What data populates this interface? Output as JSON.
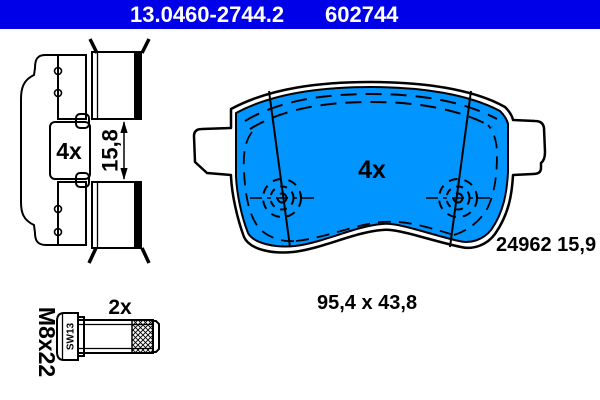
{
  "header": {
    "part_number": "13.0460-2744.2",
    "reference_number": "602744",
    "background": "#0000e8",
    "text_color": "#ffffff"
  },
  "colors": {
    "pad_friction_blue": "#0095ff",
    "outline": "#000000",
    "background": "#ffffff"
  },
  "side_view": {
    "quantity": "4x",
    "thickness": "15,8"
  },
  "front_view": {
    "quantity": "4x",
    "wva_number": "24962 15,9"
  },
  "overall_dimensions": "95,4 x 43,8",
  "bolt": {
    "quantity": "2x",
    "thread_size": "M8x22",
    "wrench_size": "SW13"
  }
}
